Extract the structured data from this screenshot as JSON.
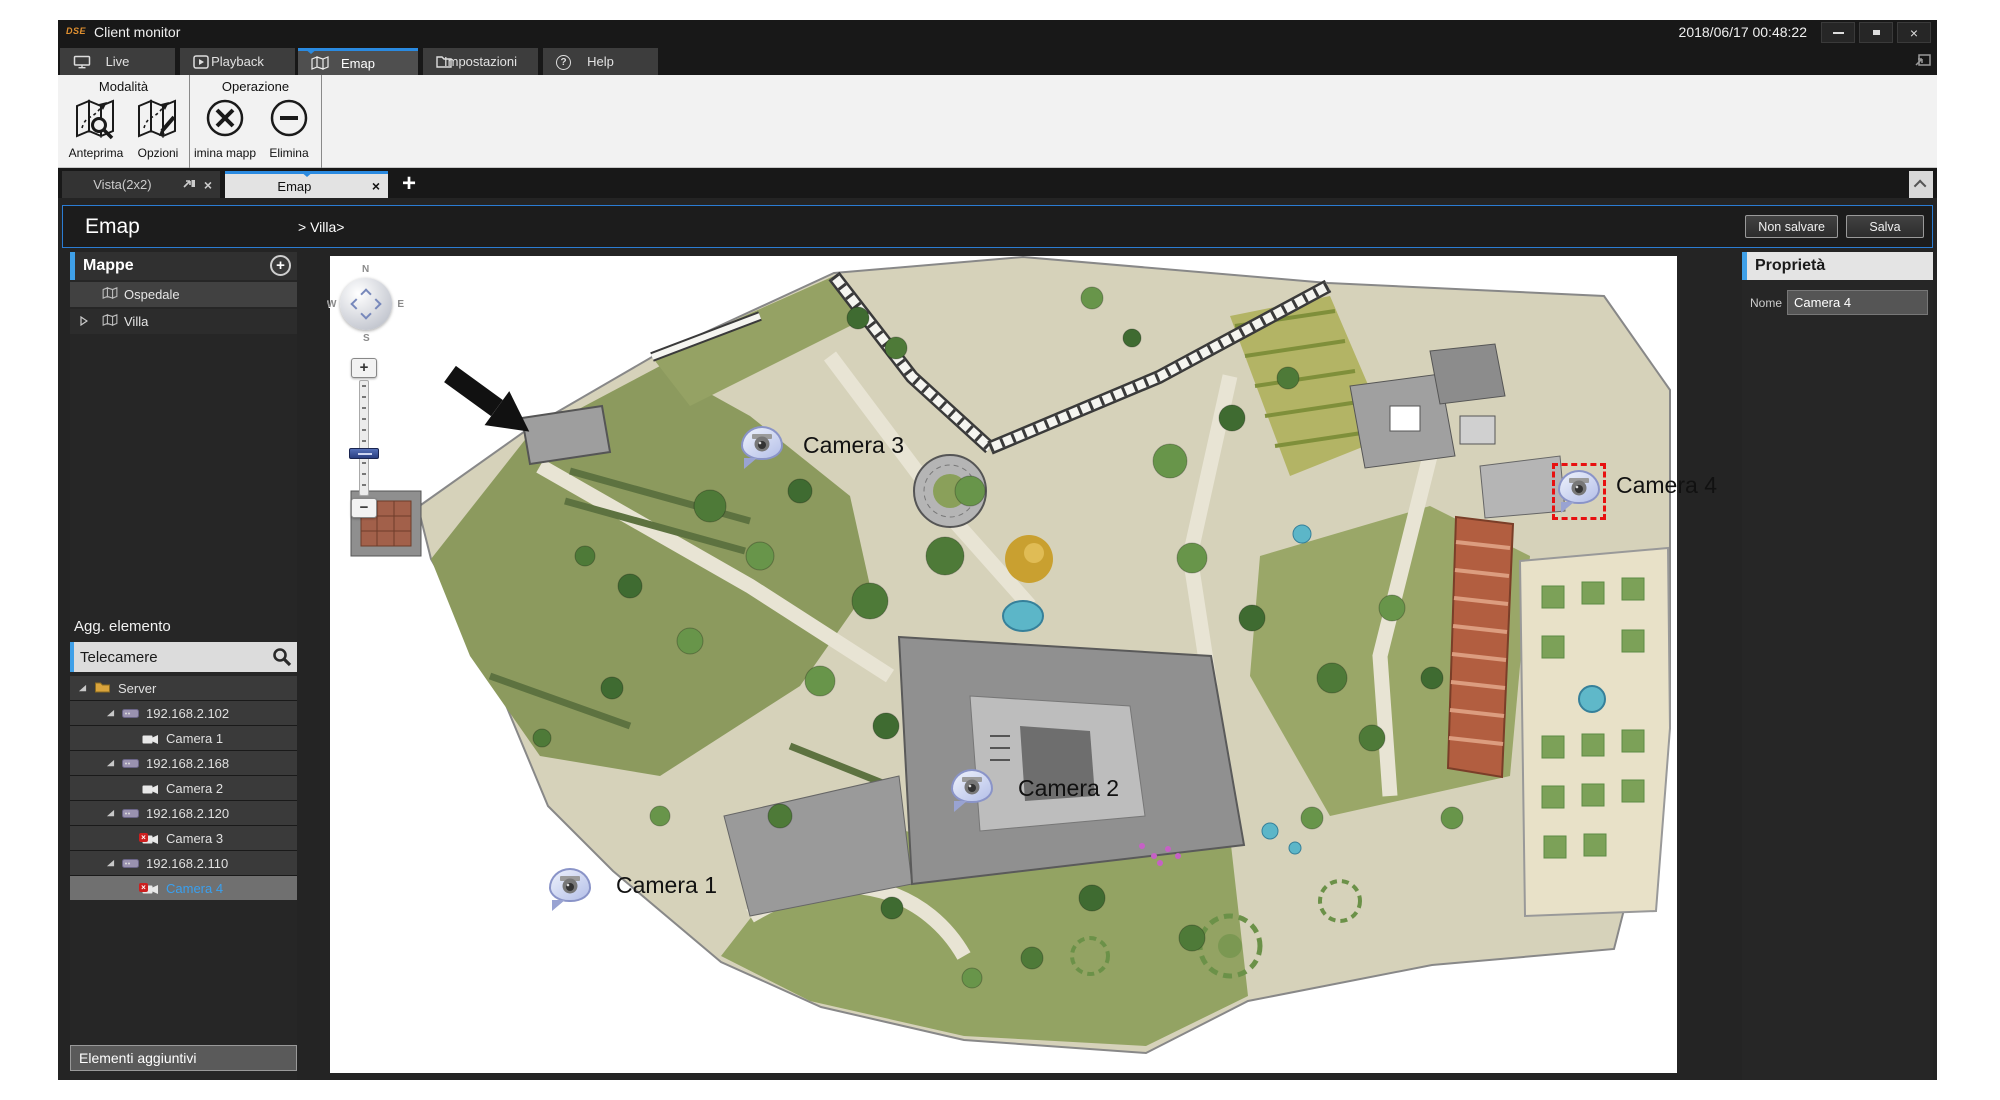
{
  "window": {
    "logo": "DSE",
    "title": "Client monitor",
    "timestamp": "2018/06/17 00:48:22"
  },
  "glyphs": {
    "plus": "+",
    "close": "×",
    "help": "?",
    "badge_x": "×"
  },
  "main_tabs": [
    {
      "label": "Live"
    },
    {
      "label": "Playback"
    },
    {
      "label": "Emap"
    },
    {
      "label": "Impostazioni"
    },
    {
      "label": "Help"
    }
  ],
  "ribbon": {
    "groups": [
      {
        "label": "Modalità"
      },
      {
        "label": "Operazione"
      }
    ],
    "buttons": [
      {
        "label": "Anteprima",
        "icon": "map-preview-icon"
      },
      {
        "label": "Opzioni",
        "icon": "map-edit-icon"
      },
      {
        "label": "imina mapp",
        "icon": "delete-map-icon"
      },
      {
        "label": "Elimina",
        "icon": "remove-icon"
      }
    ]
  },
  "view_tabs": [
    {
      "label": "Vista(2x2)"
    },
    {
      "label": "Emap"
    }
  ],
  "breadcrumb": {
    "title": "Emap",
    "path": "> Villa>"
  },
  "dialog_buttons": {
    "discard": "Non salvare",
    "save": "Salva"
  },
  "sidebar": {
    "maps_header": "Mappe",
    "maps": [
      {
        "label": "Ospedale"
      },
      {
        "label": "Villa"
      }
    ],
    "add_element_label": "Agg. elemento",
    "search_value": "Telecamere",
    "tree": [
      {
        "label": "Server"
      },
      {
        "label": "192.168.2.102"
      },
      {
        "label": "Camera 1"
      },
      {
        "label": "192.168.2.168"
      },
      {
        "label": "Camera 2"
      },
      {
        "label": "192.168.2.120"
      },
      {
        "label": "Camera 3"
      },
      {
        "label": "192.168.2.110"
      },
      {
        "label": "Camera 4"
      }
    ],
    "footer": "Elementi aggiuntivi"
  },
  "map": {
    "cameras": [
      {
        "label": "Camera 1"
      },
      {
        "label": "Camera 2"
      },
      {
        "label": "Camera 3"
      },
      {
        "label": "Camera 4",
        "selected": true
      }
    ],
    "compass": {
      "n": "N",
      "s": "S",
      "w": "W",
      "e": "E"
    },
    "zoom": {
      "plus": "+",
      "minus": "−"
    }
  },
  "properties": {
    "header": "Proprietà",
    "name_label": "Nome",
    "name_value": "Camera 4"
  },
  "colors": {
    "accent_blue": "#2a8ae0",
    "selection_red": "#e81010",
    "camera_selected_text": "#39a0f0"
  }
}
